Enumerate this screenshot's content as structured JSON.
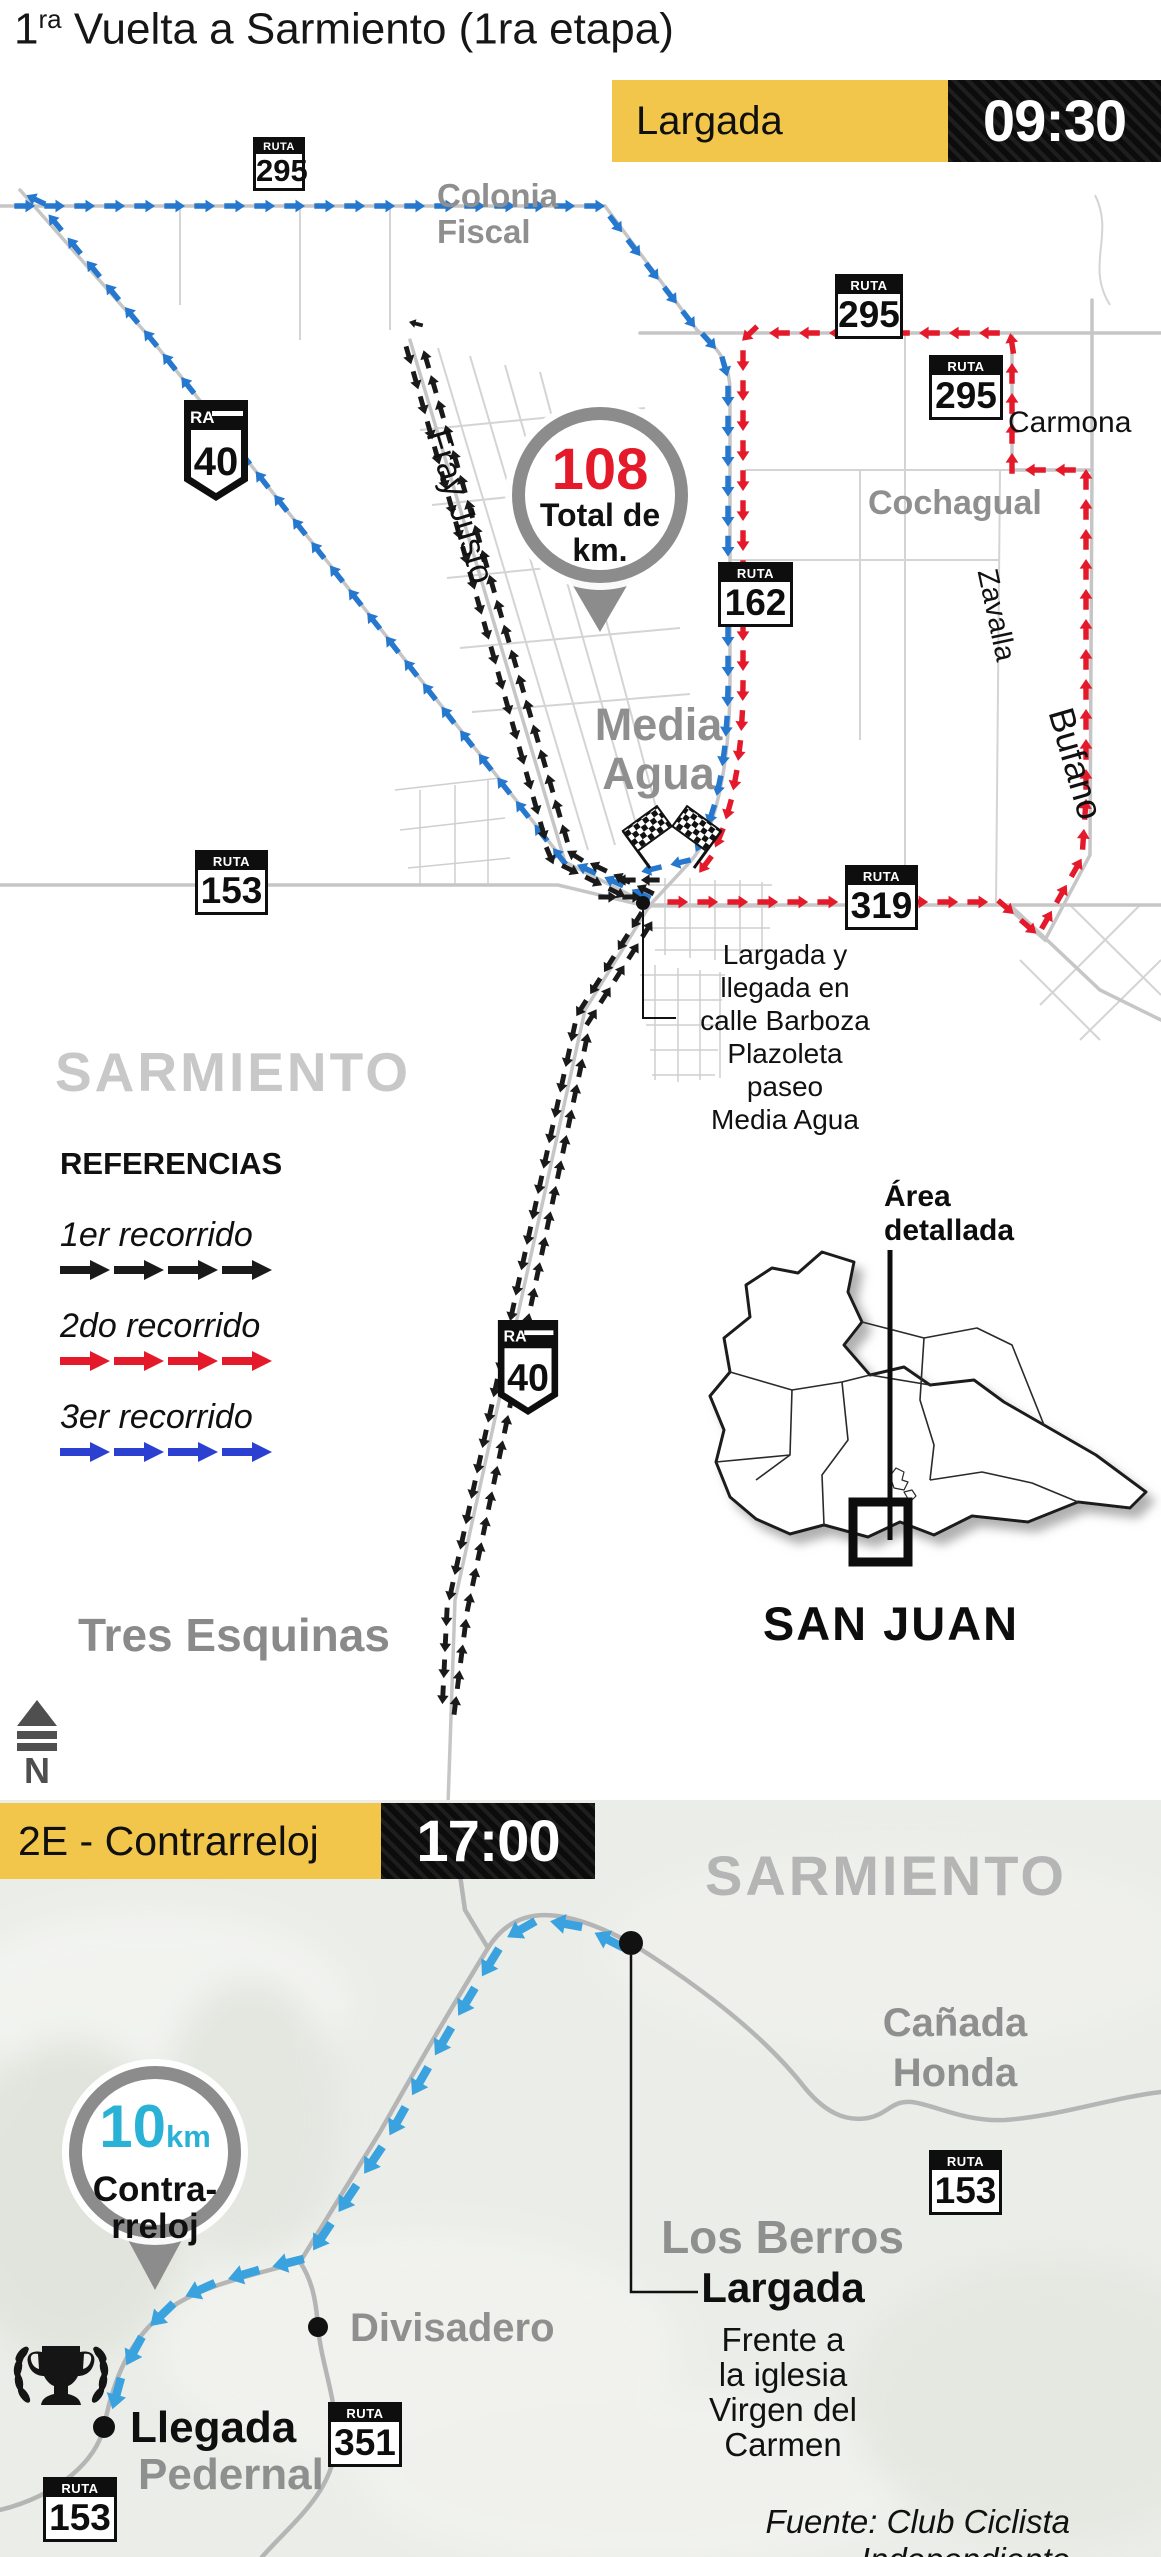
{
  "title": {
    "num": "1",
    "sup": "ra",
    "rest": " Vuelta a Sarmiento (1ra etapa)"
  },
  "colors": {
    "yellow": "#F2C64B",
    "route1": "#1a1a1a",
    "route2": "#e41a2b",
    "route3": "#2677ce",
    "route3_legend": "#2b3fd0",
    "route_tt": "#3aa3df",
    "cyan": "#29b2d6",
    "red_value": "#e41a2b",
    "road_gray": "#c6c6c6",
    "label_gray": "#8f8f8f",
    "big_gray": "#c8c8c8",
    "terrain": "#ebede8"
  },
  "shared": {
    "ruta": "RUTA",
    "ra": "RA"
  },
  "stage1": {
    "header": {
      "label": "Largada",
      "time": "09:30"
    },
    "total_pin": {
      "value": "108",
      "caption1": "Total de",
      "caption2": "km."
    },
    "badges": {
      "r295": "295",
      "r162": "162",
      "r153": "153",
      "r319": "319",
      "r40": "40"
    },
    "labels": {
      "colonia1": "Colonia",
      "colonia2": "Fiscal",
      "fray_justo": "Fray Justo",
      "carmona": "Carmona",
      "cochagual": "Cochagual",
      "zavalla": "Zavalla",
      "bufano": "Bufano",
      "media1": "Media",
      "media2": "Agua",
      "sarmiento": "SARMIENTO",
      "tres_esquinas": "Tres Esquinas"
    },
    "note": {
      "l1": "Largada y",
      "l2": "llegada en",
      "l3": "calle Barboza",
      "l4": "Plazoleta paseo",
      "l5": "Media Agua"
    },
    "legend": {
      "title": "REFERENCIAS",
      "item1": "1er recorrido",
      "item2": "2do recorrido",
      "item3": "3er recorrido"
    },
    "inset": {
      "area1": "Área",
      "area2": "detallada",
      "province": "SAN JUAN"
    },
    "north": "N"
  },
  "stage2": {
    "header": {
      "label": "2E - Contrarreloj",
      "time": "17:00"
    },
    "pin": {
      "value": "10",
      "unit": "km",
      "caption1": "Contra-",
      "caption2": "rreloj"
    },
    "badges": {
      "r153": "153",
      "r351": "351"
    },
    "labels": {
      "sarmiento": "SARMIENTO",
      "canada1": "Cañada",
      "canada2": "Honda",
      "los_berros": "Los Berros",
      "largada": "Largada",
      "divisadero": "Divisadero",
      "llegada": "Llegada",
      "pedernal": "Pedernal"
    },
    "start_note": {
      "l1": "Frente a",
      "l2": "la iglesia",
      "l3": "Virgen del",
      "l4": "Carmen"
    },
    "source": "Fuente: Club Ciclista Independiente"
  }
}
